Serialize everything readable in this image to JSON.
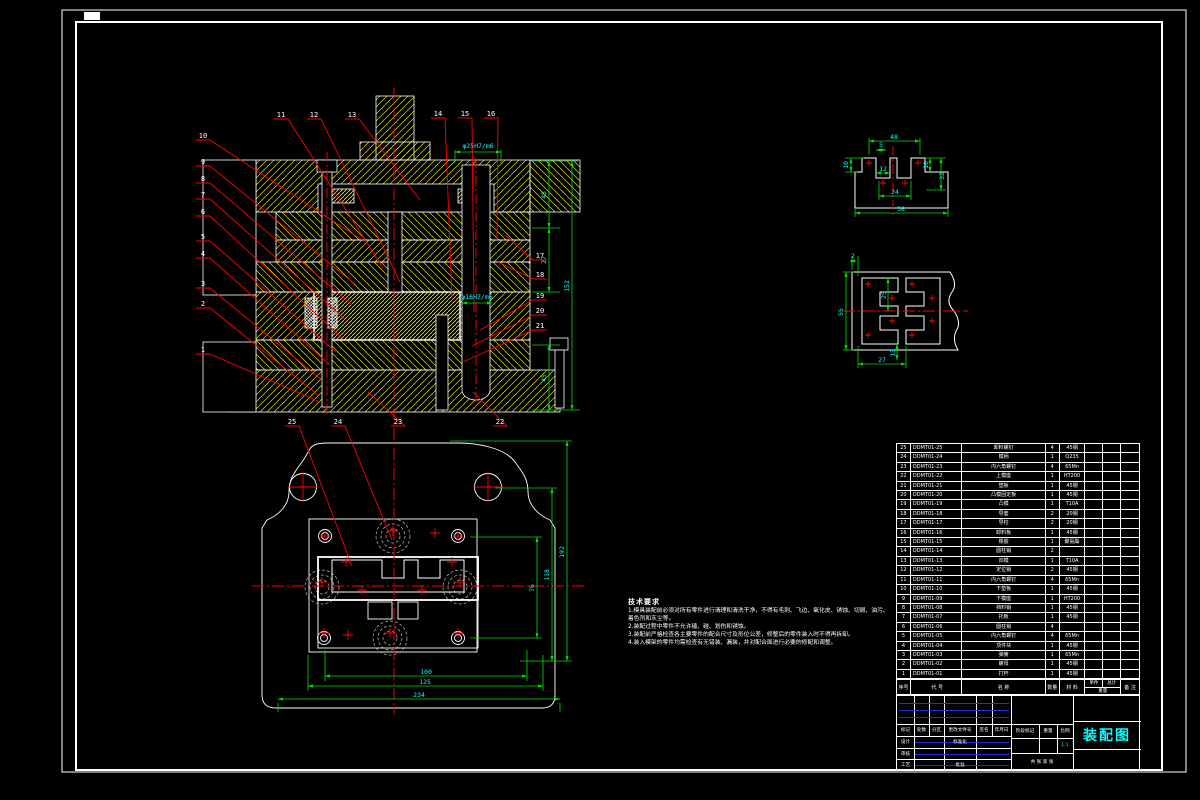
{
  "drawing": {
    "title": "装配图",
    "scale": "1:1",
    "sheet_text": "共  张  第  张"
  },
  "colors": {
    "background": "#000000",
    "outline": "#ffffff",
    "hatch": "#e6e600",
    "leader": "#ff0000",
    "dimension_line": "#00dd00",
    "dimension_text": "#00ffff",
    "title_text": "#00ffff",
    "signature_line": "#2a2ae0"
  },
  "notes": {
    "title": "技术要求",
    "lines": [
      "1.模具装配前必须对所有零件进行清理和清洗干净，不得有毛刺、飞边、氧化皮、锈蚀、切屑、油污、着色剂和灰尘等。",
      "2.装配过程中零件不允许磕、碰、划伤和锈蚀。",
      "3.装配前严格检查各主要零件的配合尺寸及形位公差，修整后的零件装入时不得再拆卸。",
      "4.装入模架的零件均需检查有无错装、漏装，并对配合面进行必要的修配和调整。"
    ]
  },
  "balloons": [
    "1",
    "2",
    "3",
    "4",
    "5",
    "6",
    "7",
    "8",
    "9",
    "10",
    "11",
    "12",
    "13",
    "14",
    "15",
    "16",
    "17",
    "18",
    "19",
    "20",
    "21",
    "22",
    "23",
    "24",
    "25"
  ],
  "dims": {
    "section": [
      "45",
      "27",
      "152",
      "45",
      "φ25H7/m6",
      "φ16H7/m6"
    ],
    "plan_right": [
      "76",
      "118",
      "192"
    ],
    "plan_bottom": [
      "100",
      "125",
      "234"
    ],
    "detail1": [
      "48",
      "5",
      "10",
      "12",
      "10",
      "32",
      "24",
      "58"
    ],
    "detail2": [
      "2",
      "25",
      "55",
      "13",
      "27"
    ]
  },
  "bom": {
    "headers": {
      "no": "序号",
      "code": "代 号",
      "name": "名 称",
      "qty": "数量",
      "material": "材 料",
      "unit": "单件",
      "total": "总计",
      "weight": "重量",
      "remark": "备 注"
    },
    "rows": [
      {
        "no": "25",
        "code": "DDMT01-25",
        "name": "卸料螺钉",
        "qty": "4",
        "material": "45钢",
        "unit": "",
        "total": "",
        "remark": ""
      },
      {
        "no": "24",
        "code": "DDMT01-24",
        "name": "模柄",
        "qty": "1",
        "material": "Q235",
        "unit": "",
        "total": "",
        "remark": ""
      },
      {
        "no": "23",
        "code": "DDMT01-23",
        "name": "内六角螺钉",
        "qty": "4",
        "material": "65Mn",
        "unit": "",
        "total": "",
        "remark": ""
      },
      {
        "no": "22",
        "code": "DDMT01-22",
        "name": "上模座",
        "qty": "1",
        "material": "HT200",
        "unit": "",
        "total": "",
        "remark": ""
      },
      {
        "no": "21",
        "code": "DDMT01-21",
        "name": "垫板",
        "qty": "1",
        "material": "45钢",
        "unit": "",
        "total": "",
        "remark": ""
      },
      {
        "no": "20",
        "code": "DDMT01-20",
        "name": "凸模固定板",
        "qty": "1",
        "material": "45钢",
        "unit": "",
        "total": "",
        "remark": ""
      },
      {
        "no": "19",
        "code": "DDMT01-19",
        "name": "凸模",
        "qty": "1",
        "material": "T10A",
        "unit": "",
        "total": "",
        "remark": ""
      },
      {
        "no": "18",
        "code": "DDMT01-18",
        "name": "导套",
        "qty": "2",
        "material": "20钢",
        "unit": "",
        "total": "",
        "remark": ""
      },
      {
        "no": "17",
        "code": "DDMT01-17",
        "name": "导柱",
        "qty": "2",
        "material": "20钢",
        "unit": "",
        "total": "",
        "remark": ""
      },
      {
        "no": "16",
        "code": "DDMT01-16",
        "name": "卸料板",
        "qty": "1",
        "material": "45钢",
        "unit": "",
        "total": "",
        "remark": ""
      },
      {
        "no": "15",
        "code": "DDMT01-15",
        "name": "橡胶",
        "qty": "1",
        "material": "聚氨酯",
        "unit": "",
        "total": "",
        "remark": ""
      },
      {
        "no": "14",
        "code": "DDMT01-14",
        "name": "圆柱销",
        "qty": "2",
        "material": "",
        "unit": "",
        "total": "",
        "remark": ""
      },
      {
        "no": "13",
        "code": "DDMT01-13",
        "name": "凹模",
        "qty": "1",
        "material": "T10A",
        "unit": "",
        "total": "",
        "remark": ""
      },
      {
        "no": "12",
        "code": "DDMT01-12",
        "name": "定位销",
        "qty": "2",
        "material": "45钢",
        "unit": "",
        "total": "",
        "remark": ""
      },
      {
        "no": "11",
        "code": "DDMT01-11",
        "name": "内六角螺钉",
        "qty": "4",
        "material": "65Mn",
        "unit": "",
        "total": "",
        "remark": ""
      },
      {
        "no": "10",
        "code": "DDMT01-10",
        "name": "下垫板",
        "qty": "1",
        "material": "45钢",
        "unit": "",
        "total": "",
        "remark": ""
      },
      {
        "no": "9",
        "code": "DDMT01-09",
        "name": "下模座",
        "qty": "1",
        "material": "HT200",
        "unit": "",
        "total": "",
        "remark": ""
      },
      {
        "no": "8",
        "code": "DDMT01-08",
        "name": "挡料销",
        "qty": "1",
        "material": "45钢",
        "unit": "",
        "total": "",
        "remark": ""
      },
      {
        "no": "7",
        "code": "DDMT01-07",
        "name": "托板",
        "qty": "1",
        "material": "45钢",
        "unit": "",
        "total": "",
        "remark": ""
      },
      {
        "no": "6",
        "code": "DDMT01-06",
        "name": "圆柱销",
        "qty": "4",
        "material": "",
        "unit": "",
        "total": "",
        "remark": ""
      },
      {
        "no": "5",
        "code": "DDMT01-05",
        "name": "内六角螺钉",
        "qty": "4",
        "material": "65Mn",
        "unit": "",
        "total": "",
        "remark": ""
      },
      {
        "no": "4",
        "code": "DDMT01-04",
        "name": "顶件块",
        "qty": "1",
        "material": "45钢",
        "unit": "",
        "total": "",
        "remark": ""
      },
      {
        "no": "3",
        "code": "DDMT01-03",
        "name": "弹簧",
        "qty": "1",
        "material": "65Mn",
        "unit": "",
        "total": "",
        "remark": ""
      },
      {
        "no": "2",
        "code": "DDMT01-02",
        "name": "螺母",
        "qty": "1",
        "material": "45钢",
        "unit": "",
        "total": "",
        "remark": ""
      },
      {
        "no": "1",
        "code": "DDMT01-01",
        "name": "打杆",
        "qty": "1",
        "material": "45钢",
        "unit": "",
        "total": "",
        "remark": ""
      }
    ]
  },
  "title_block": {
    "mark": "标记",
    "count": "处数",
    "zone": "分区",
    "change_doc": "更改文件号",
    "sign": "签名",
    "date": "年月日",
    "design": "设计",
    "standard": "标准化",
    "check": "审核",
    "process": "工艺",
    "approve": "批准",
    "stage_mark": "阶段标记",
    "weight": "重量",
    "scale_label": "比例"
  }
}
